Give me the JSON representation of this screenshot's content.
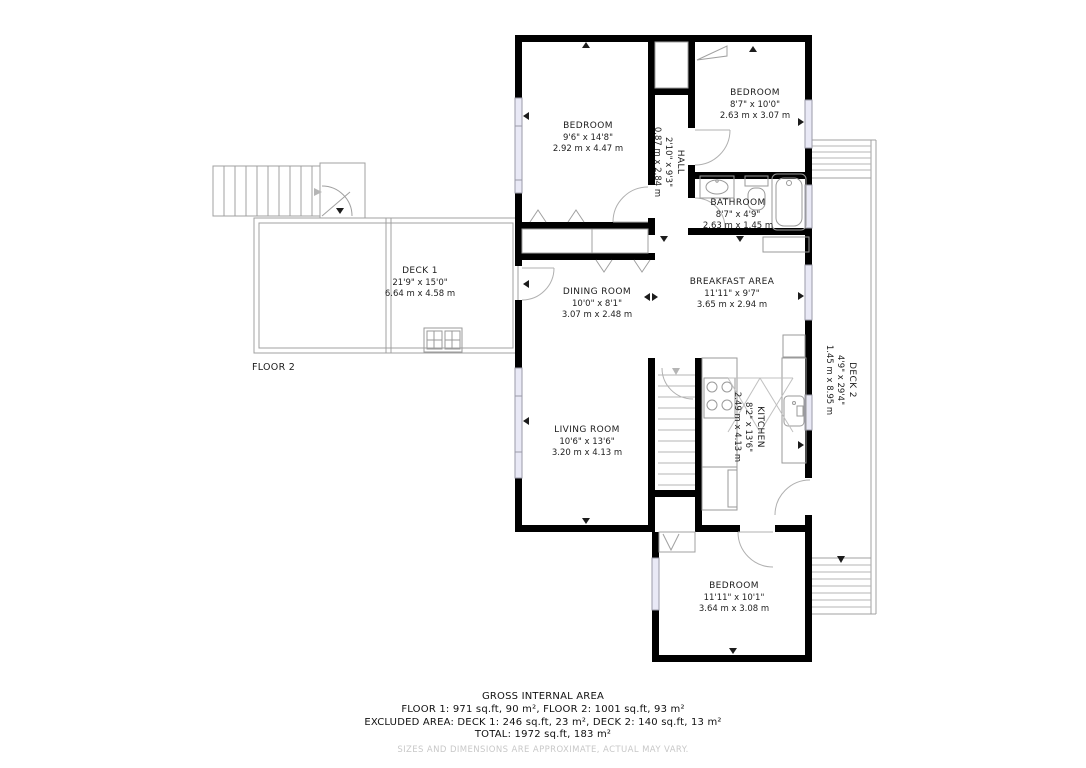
{
  "plan": {
    "floor_label": "FLOOR 2",
    "rooms": {
      "bedroom1": {
        "name": "BEDROOM",
        "imperial": "9'6\" x 14'8\"",
        "metric": "2.92 m x 4.47 m"
      },
      "bedroom2": {
        "name": "BEDROOM",
        "imperial": "8'7\" x 10'0\"",
        "metric": "2.63 m x 3.07 m"
      },
      "hall": {
        "name": "HALL",
        "imperial": "2'10\" x 9'3\"",
        "metric": "0.87 m x 2.84 m"
      },
      "bathroom": {
        "name": "BATHROOM",
        "imperial": "8'7\" x 4'9\"",
        "metric": "2.63 m x 1.45 m"
      },
      "dining": {
        "name": "DINING ROOM",
        "imperial": "10'0\" x 8'1\"",
        "metric": "3.07 m x 2.48 m"
      },
      "breakfast": {
        "name": "BREAKFAST AREA",
        "imperial": "11'11\" x 9'7\"",
        "metric": "3.65 m x 2.94 m"
      },
      "living": {
        "name": "LIVING ROOM",
        "imperial": "10'6\" x 13'6\"",
        "metric": "3.20 m x 4.13 m"
      },
      "kitchen": {
        "name": "KITCHEN",
        "imperial": "8'2\" x 13'6\"",
        "metric": "2.49 m x 4.13 m"
      },
      "bedroom3": {
        "name": "BEDROOM",
        "imperial": "11'11\" x 10'1\"",
        "metric": "3.64 m x 3.08 m"
      },
      "deck1": {
        "name": "DECK 1",
        "imperial": "21'9\" x 15'0\"",
        "metric": "6.64 m x 4.58 m"
      },
      "deck2": {
        "name": "DECK 2",
        "imperial": "4'9\" x 29'4\"",
        "metric": "1.45 m x 8.95 m"
      }
    },
    "footer": {
      "title": "GROSS INTERNAL AREA",
      "line1": "FLOOR 1: 971 sq.ft, 90 m², FLOOR 2: 1001 sq.ft, 93 m²",
      "line2": "EXCLUDED AREA: DECK 1: 246 sq.ft, 23 m², DECK 2: 140 sq.ft, 13 m²",
      "line3": "TOTAL: 1972 sq.ft, 183 m²",
      "disclaimer": "SIZES AND DIMENSIONS ARE APPROXIMATE, ACTUAL MAY VARY."
    },
    "colors": {
      "wall": "#000000",
      "window": "#e9e9f6",
      "thin_outline": "#a0a0a0",
      "stair_line": "#b5b5b5",
      "label_text": "#1c1c1c",
      "disclaimer_text": "#c8c8c8"
    }
  }
}
